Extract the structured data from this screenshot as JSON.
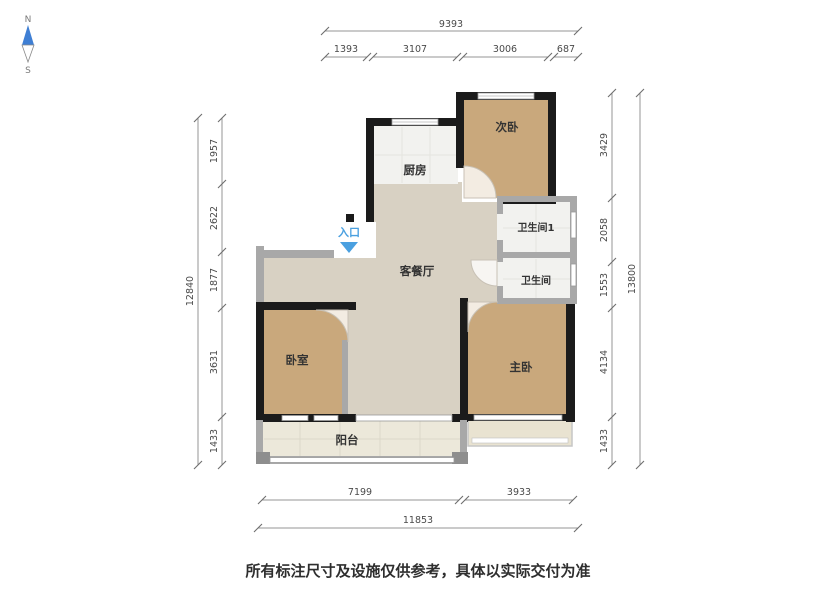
{
  "compass": {
    "north": "N",
    "south": "S"
  },
  "rooms": {
    "kitchen": {
      "label": "厨房"
    },
    "secondary_bedroom": {
      "label": "次卧"
    },
    "bathroom_1": {
      "label": "卫生间1"
    },
    "bathroom_2": {
      "label": "卫生间"
    },
    "living_dining": {
      "label": "客餐厅"
    },
    "entrance": {
      "label": "入口"
    },
    "bedroom": {
      "label": "卧室"
    },
    "master_bedroom": {
      "label": "主卧"
    },
    "balcony": {
      "label": "阳台"
    }
  },
  "dimensions": {
    "top": {
      "total": "9393",
      "segments": [
        "1393",
        "3107",
        "3006",
        "687"
      ]
    },
    "left": {
      "total": "12840",
      "segments": [
        "1957",
        "2622",
        "1877",
        "3631",
        "1433"
      ]
    },
    "right": {
      "total": "13800",
      "segments": [
        "3429",
        "2058",
        "1553",
        "4134",
        "1433"
      ]
    },
    "bottom": {
      "segments": [
        "7199",
        "3933"
      ],
      "total": "11853"
    }
  },
  "footer": {
    "disclaimer": "所有标注尺寸及设施仅供参考，具体以实际交付为准"
  },
  "colors": {
    "wall": "#1b1b1b",
    "partition": "#a8a8a8",
    "floor_wood": "#c9a87c",
    "floor_living": "#d8d1c3",
    "floor_tile": "#f2f2ef",
    "floor_balcony": "#ece8da",
    "entrance_accent": "#4aa0e0",
    "compass_north": "#3f7fd4",
    "dimension_text": "#4a4a4a"
  }
}
